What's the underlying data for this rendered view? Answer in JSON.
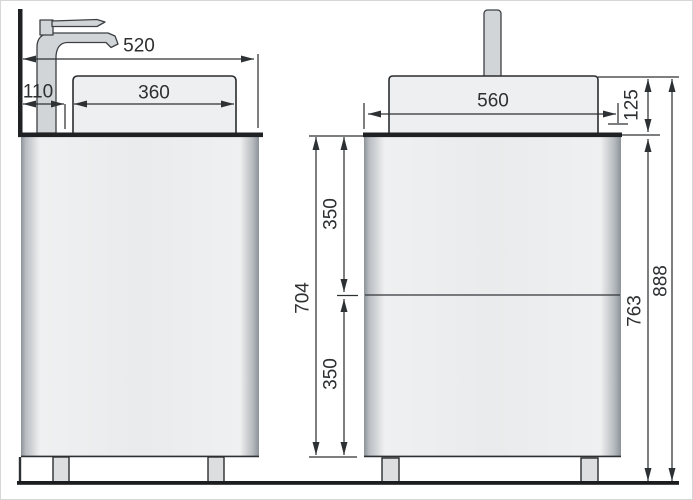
{
  "drawing": {
    "type": "technical-dimension-drawing",
    "subject": "bathroom vanity with countertop washbasin and faucet",
    "views": {
      "side_view": "left",
      "front_view": "right"
    },
    "line_color": "#2e3133",
    "fill_light": "#edeff0",
    "fill_metal": "#d2d5d7"
  },
  "dimensions": {
    "side_total_depth": "520",
    "side_wall_to_basin": "110",
    "side_basin_depth": "360",
    "front_cabinet_width": "560",
    "front_basin_height": "125",
    "front_cabinet_height": "704",
    "front_drawer_upper": "350",
    "front_drawer_lower": "350",
    "front_floor_to_counter": "763",
    "front_total_height": "888"
  }
}
